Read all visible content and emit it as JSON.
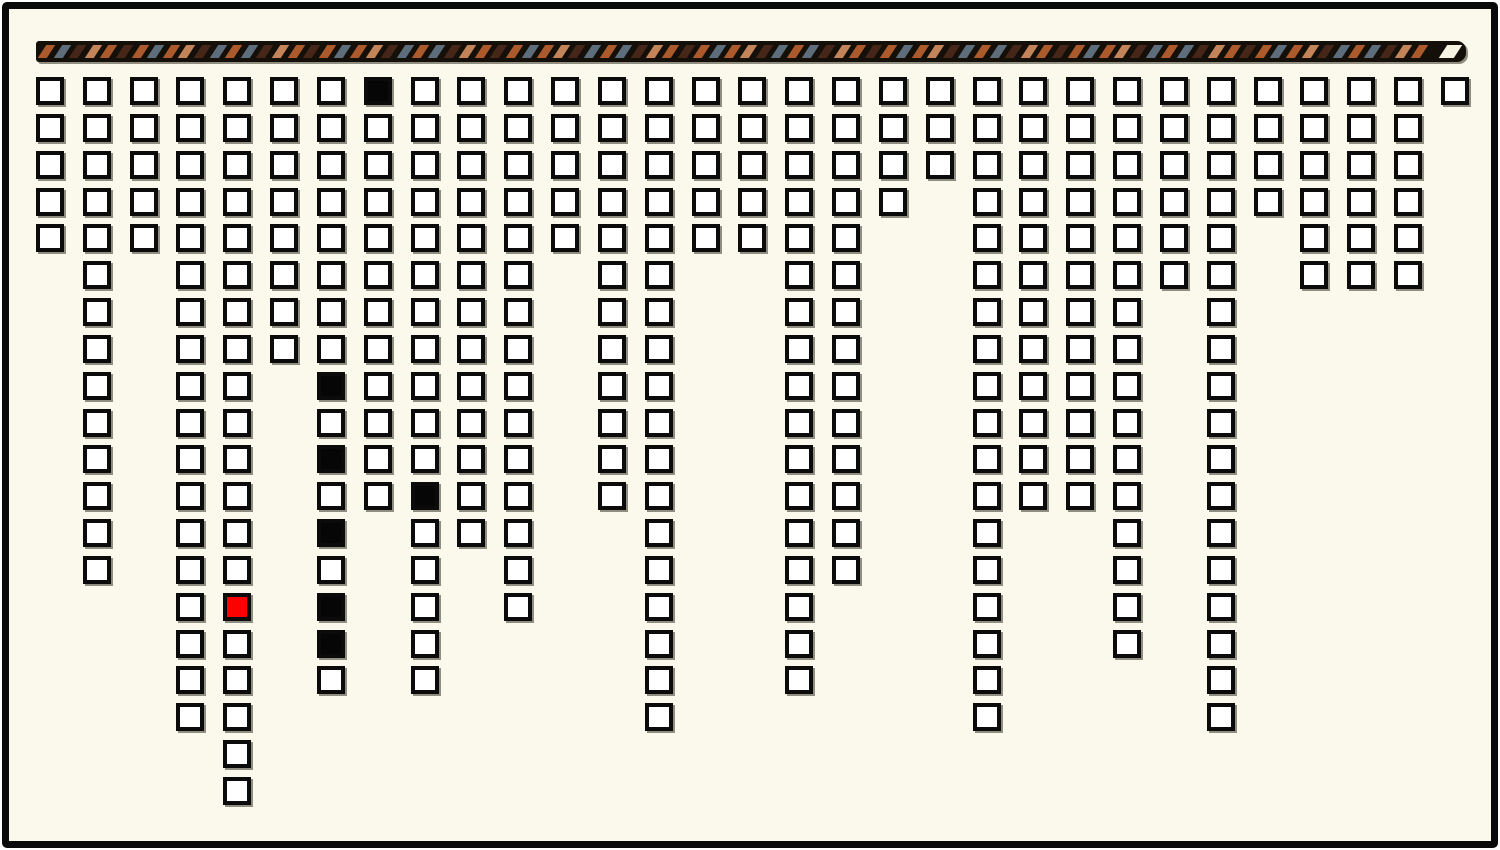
{
  "app": {
    "canvas_width": 1500,
    "canvas_height": 850,
    "outer_background": "#FFFFFF",
    "canvas_background": "#FAF9EB",
    "frame_color": "#0A0A0A",
    "frame_inset": 2,
    "frame_border_width": 7
  },
  "ribbon": {
    "x": 36,
    "y": 41,
    "width": 1430,
    "height": 21,
    "background": "#140F08",
    "stripe_top": 4,
    "stripe_height": 13,
    "stripe_width": 9,
    "stripe_pitch": 15.6,
    "stripe_skew_deg": -33,
    "inset_left": 6,
    "end_stripe_offset_right": 23,
    "end_stripe_width": 15,
    "colors": {
      "orange": "#AC5A2C",
      "slate": "#5E6D7C",
      "brown": "#47261A",
      "tan": "#C4845A",
      "cream": "#F7F3E3"
    },
    "pattern": [
      "orange",
      "slate",
      "brown",
      "tan",
      "orange",
      "brown",
      "orange",
      "slate",
      "orange",
      "tan",
      "brown",
      "slate"
    ],
    "end_stripe_color": "cream"
  },
  "board": {
    "origin_x": 36,
    "origin_y": 77,
    "col_pitch": 46.83,
    "row_pitch": 36.84,
    "cell_size": 28,
    "cell_border_width": 4,
    "cell_border_color": "#0B0B0B",
    "cell_fill": "#FFFFFF",
    "filled_fill": "#060606",
    "active_fill": "#FB0100",
    "shadow_color": "#8F8E81",
    "num_columns": 31,
    "column_heights": [
      5,
      14,
      5,
      18,
      20,
      8,
      17,
      12,
      17,
      13,
      15,
      5,
      12,
      18,
      5,
      5,
      17,
      14,
      4,
      3,
      18,
      12,
      12,
      16,
      6,
      18,
      4,
      6,
      6,
      6,
      1
    ],
    "filled_cells": [
      [
        7,
        9
      ],
      [
        7,
        11
      ],
      [
        7,
        13
      ],
      [
        7,
        15
      ],
      [
        7,
        16
      ],
      [
        8,
        1
      ],
      [
        9,
        12
      ]
    ],
    "active_cell": [
      5,
      15
    ]
  }
}
